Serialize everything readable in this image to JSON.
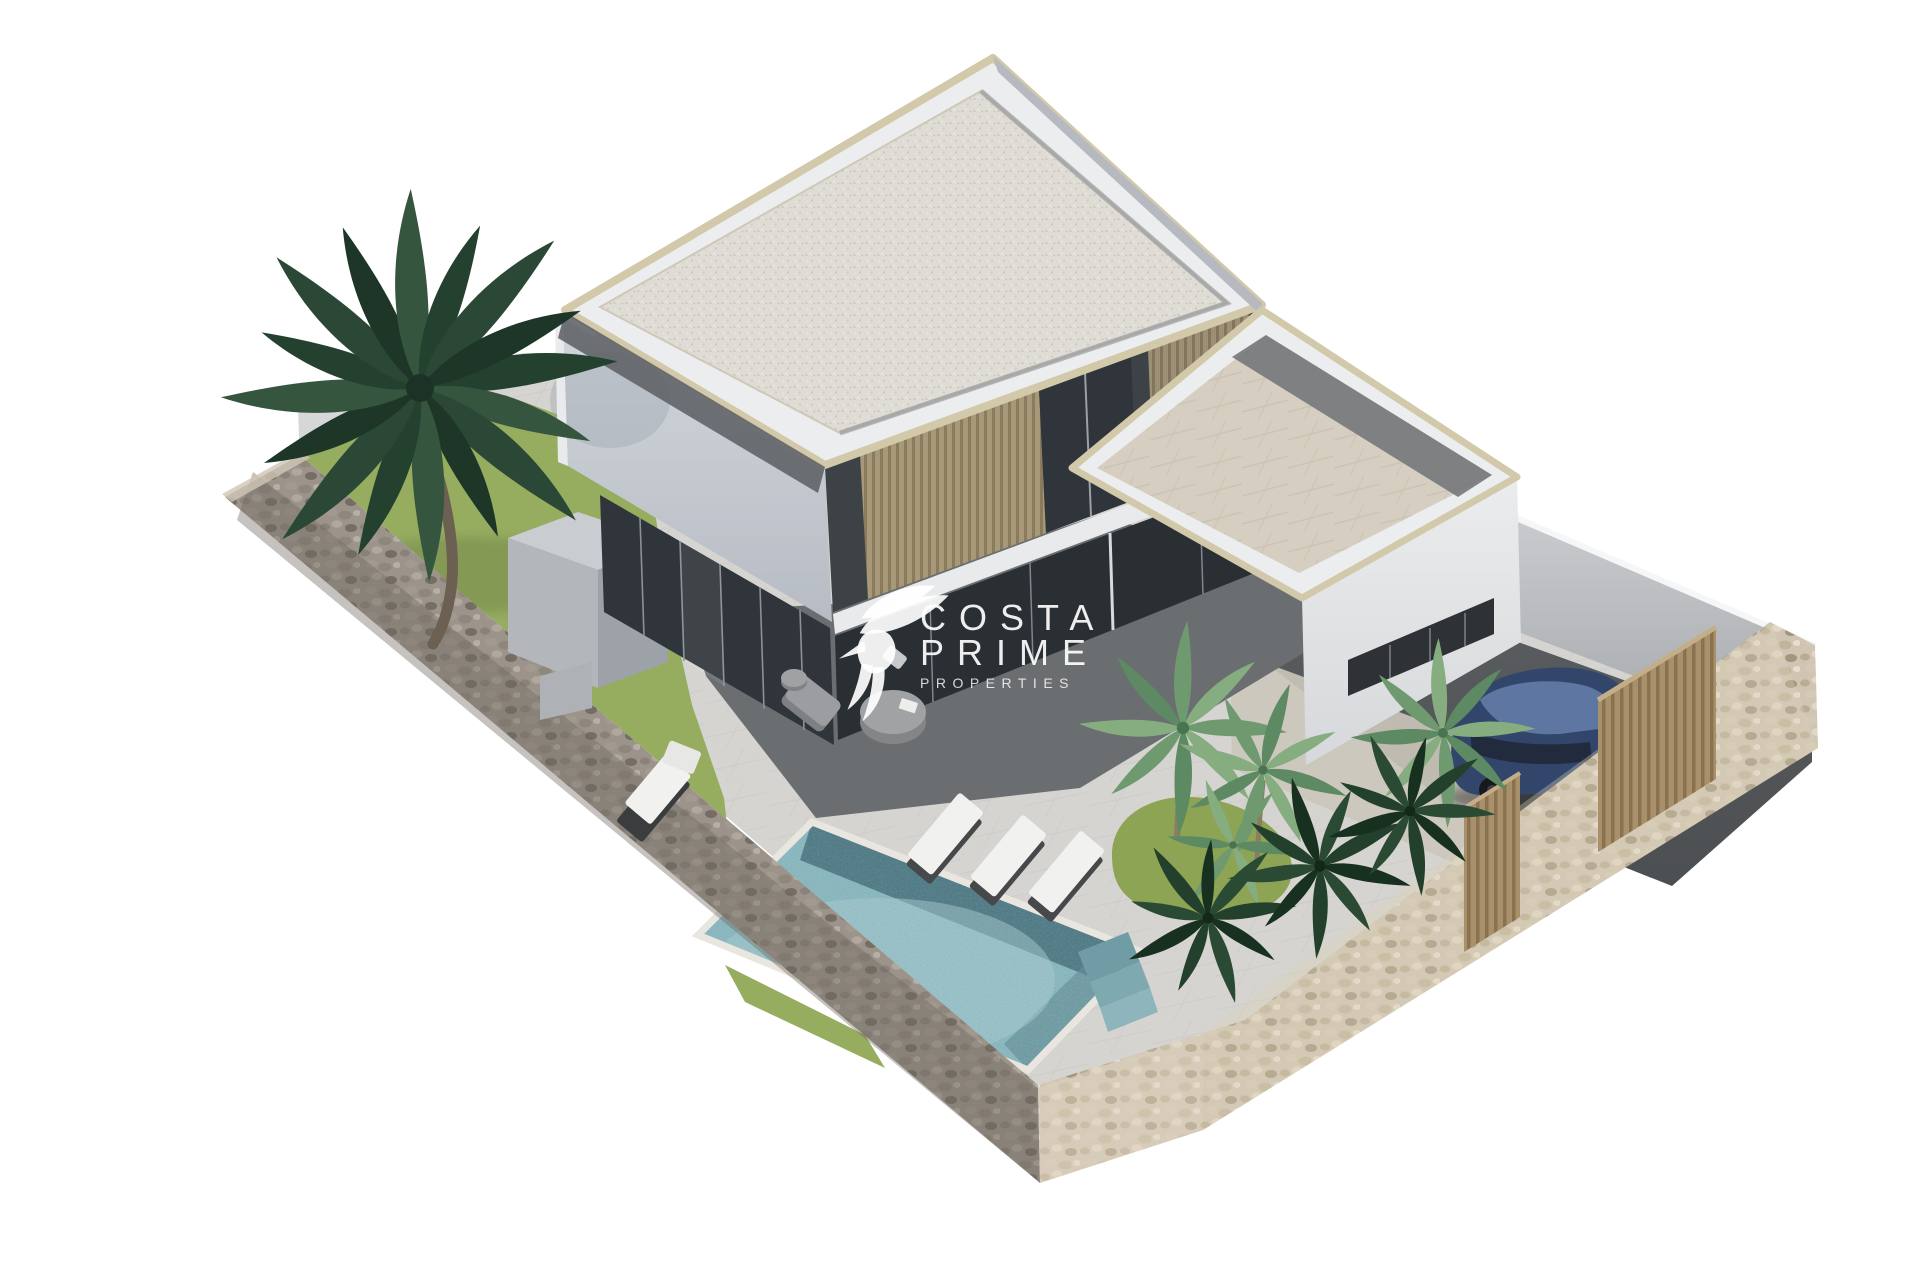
{
  "watermark": {
    "line1": "COSTA",
    "line2": "PRIME",
    "line3": "PROPERTIES",
    "logo": "hummingbird-icon",
    "color": "#ffffff"
  },
  "scene": {
    "type": "3d-architectural-render",
    "view": "aerial-isometric",
    "background": "#ffffff",
    "objects": [
      "two-storey-modern-villa",
      "flat-gravel-roof",
      "wood-louvre-balcony",
      "single-storey-wing-roof-terrace",
      "swimming-pool-with-steps",
      "stone-perimeter-wall",
      "bronze-entrance-gates",
      "blue-car",
      "driveway",
      "large-palm-tree",
      "small-palm-garden",
      "sun-loungers",
      "outdoor-lounge-set",
      "lawn",
      "utility-cube"
    ]
  },
  "colors": {
    "background": "#ffffff",
    "pavement": "#d6d4d0",
    "pavement_joint": "#c7c5c1",
    "patio_shade": "#6b6e70",
    "grass": "#96ac5f",
    "garden_grass": "#8da455",
    "pool_water": "#85b7bf",
    "pool_deep": "#43707c",
    "pool_light": "#a5ccd1",
    "pool_coping": "#e9e6df",
    "stone_dark_base": "#9c948b",
    "stone_light_base": "#cfc5b2",
    "facade_main": "#c9ced5",
    "facade_white": "#ecedee",
    "roof_gravel": "#dfdcd5",
    "coping_beige": "#d2c9ab",
    "louver_wood": "#a79878",
    "glass_dark": "#2f353a",
    "balustrade_glass": "#5d6165",
    "terrace_tile": "#d5cec1",
    "terrace_band": "#77797c",
    "wing_facade": "#e7e8ea",
    "boundary_wall": "#c9cccf",
    "driveway": "#54575a",
    "gate_bronze": "#a8906a",
    "car_blue": "#32466b",
    "car_glass": "#222b3e",
    "car_roof_highlight": "#5d76a2",
    "palm_dark": "#2e4b3a",
    "palm_light": "#6f9a6f",
    "trunk_brown": "#6b6052",
    "furniture_gray": "#9b9da0",
    "lounger_white": "#f1f1f0"
  }
}
